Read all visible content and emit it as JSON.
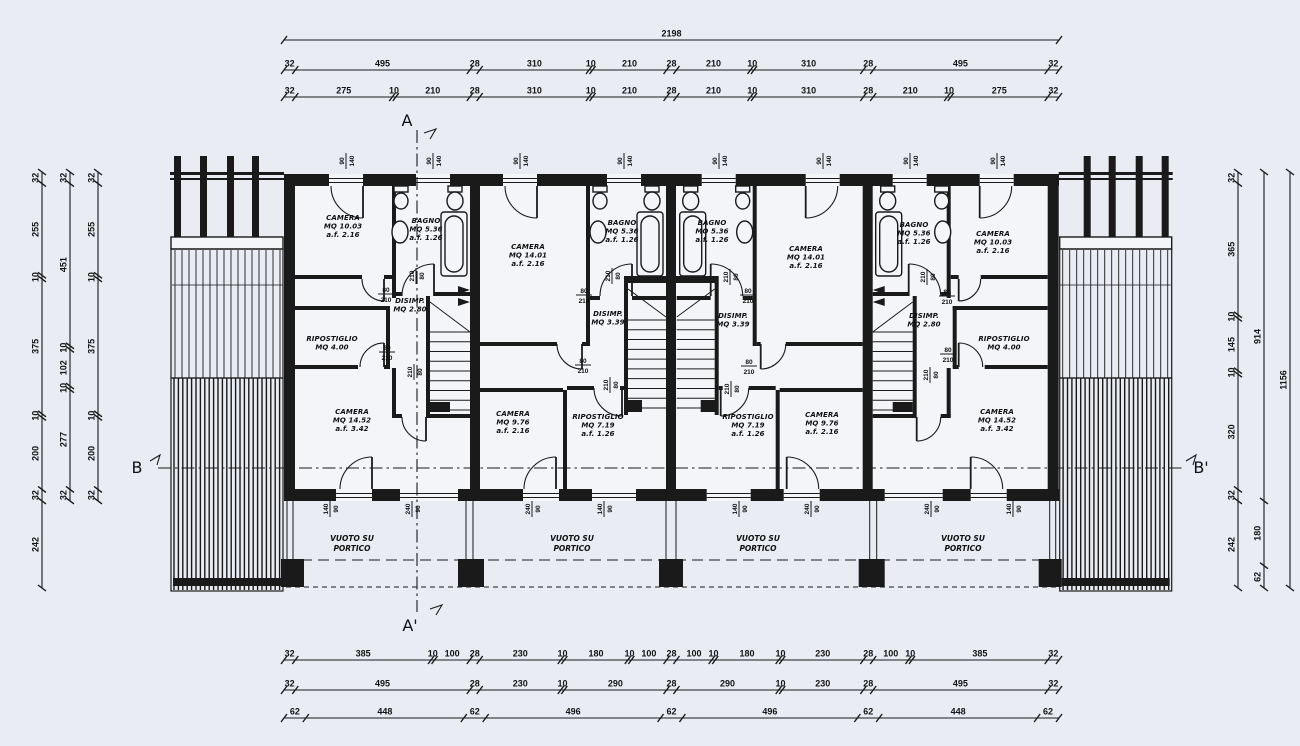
{
  "colors": {
    "paper": "#e9ecf3",
    "room_fill": "#f4f5f9",
    "ink": "#1a1a1a"
  },
  "sections": {
    "top": "A",
    "bottom": "A'",
    "left": "B",
    "right": "B'"
  },
  "dimensions": {
    "top": [
      [
        "2198"
      ],
      [
        "32",
        "495",
        "28",
        "310",
        "10",
        "210",
        "28",
        "210",
        "10",
        "310",
        "28",
        "495",
        "32"
      ],
      [
        "32",
        "275",
        "10",
        "210",
        "28",
        "310",
        "10",
        "210",
        "28",
        "210",
        "10",
        "310",
        "28",
        "210",
        "10",
        "275",
        "32"
      ]
    ],
    "bottom": [
      [
        "32",
        "385",
        "10",
        "100",
        "28",
        "230",
        "10",
        "180",
        "10",
        "100",
        "28",
        "100",
        "10",
        "180",
        "10",
        "230",
        "28",
        "100",
        "10",
        "385",
        "32"
      ],
      [
        "32",
        "495",
        "28",
        "230",
        "10",
        "290",
        "28",
        "290",
        "10",
        "230",
        "28",
        "495",
        "32"
      ],
      [
        "62",
        "448",
        "62",
        "496",
        "62",
        "496",
        "62",
        "448",
        "62"
      ]
    ],
    "left": [
      [
        "32",
        "255",
        "10",
        "375",
        "10",
        "200",
        "32",
        "242"
      ],
      [
        "32",
        "451",
        "10",
        "102",
        "10",
        "277",
        "32"
      ],
      [
        "32",
        "255",
        "10",
        "375",
        "10",
        "200",
        "32"
      ]
    ],
    "right": [
      [
        "32",
        "365",
        "10",
        "145",
        "10",
        "320",
        "32",
        "242"
      ],
      [
        "914",
        "180",
        "62"
      ],
      [
        "1156"
      ]
    ]
  },
  "rooms": [
    {
      "name": "CAMERA",
      "area": "MQ 10.03",
      "height": "a.f. 2.16"
    },
    {
      "name": "BAGNO",
      "area": "MQ 5.36",
      "height": "a.f. 1.26"
    },
    {
      "name": "DISIMP.",
      "area": "MQ 2.80",
      "height": ""
    },
    {
      "name": "RIPOSTIGLIO",
      "area": "MQ 4.00",
      "height": ""
    },
    {
      "name": "CAMERA",
      "area": "MQ 14.52",
      "height": "a.f. 3.42"
    },
    {
      "name": "CAMERA",
      "area": "MQ 14.01",
      "height": "a.f. 2.16"
    },
    {
      "name": "BAGNO",
      "area": "MQ 5.36",
      "height": "a.f. 1.26"
    },
    {
      "name": "DISIMP.",
      "area": "MQ 3.39",
      "height": ""
    },
    {
      "name": "CAMERA",
      "area": "MQ 9.76",
      "height": "a.f. 2.16"
    },
    {
      "name": "RIPOSTIGLIO",
      "area": "MQ 7.19",
      "height": "a.f. 1.26"
    },
    {
      "name": "BAGNO",
      "area": "MQ 5.36",
      "height": "a.f. 1.26"
    },
    {
      "name": "CAMERA",
      "area": "MQ 14.01",
      "height": "a.f. 2.16"
    },
    {
      "name": "DISIMP.",
      "area": "MQ 3.39",
      "height": ""
    },
    {
      "name": "RIPOSTIGLIO",
      "area": "MQ 7.19",
      "height": "a.f. 1.26"
    },
    {
      "name": "CAMERA",
      "area": "MQ 9.76",
      "height": "a.f. 2.16"
    },
    {
      "name": "BAGNO",
      "area": "MQ 5.36",
      "height": "a.f. 1.26"
    },
    {
      "name": "CAMERA",
      "area": "MQ 10.03",
      "height": "a.f. 2.16"
    },
    {
      "name": "DISIMP.",
      "area": "MQ 2.80",
      "height": ""
    },
    {
      "name": "RIPOSTIGLIO",
      "area": "MQ 4.00",
      "height": ""
    },
    {
      "name": "CAMERA",
      "area": "MQ 14.52",
      "height": "a.f. 3.42"
    }
  ],
  "porch_bays": [
    {
      "line1": "VUOTO SU",
      "line2": "PORTICO"
    },
    {
      "line1": "VUOTO SU",
      "line2": "PORTICO"
    },
    {
      "line1": "VUOTO SU",
      "line2": "PORTICO"
    },
    {
      "line1": "VUOTO SU",
      "line2": "PORTICO"
    }
  ],
  "size_labels": [
    {
      "num": "90",
      "den": "140"
    },
    {
      "num": "90",
      "den": "140"
    },
    {
      "num": "90",
      "den": "140"
    },
    {
      "num": "90",
      "den": "140"
    },
    {
      "num": "90",
      "den": "140"
    },
    {
      "num": "90",
      "den": "140"
    },
    {
      "num": "90",
      "den": "140"
    },
    {
      "num": "90",
      "den": "140"
    },
    {
      "num": "140",
      "den": "90"
    },
    {
      "num": "240",
      "den": "90"
    },
    {
      "num": "240",
      "den": "90"
    },
    {
      "num": "140",
      "den": "90"
    },
    {
      "num": "140",
      "den": "90"
    },
    {
      "num": "240",
      "den": "90"
    },
    {
      "num": "240",
      "den": "90"
    },
    {
      "num": "140",
      "den": "90"
    },
    {
      "num": "80",
      "den": "210"
    },
    {
      "num": "80",
      "den": "210"
    },
    {
      "num": "210",
      "den": "80"
    },
    {
      "num": "210",
      "den": "80"
    },
    {
      "num": "80",
      "den": "210"
    },
    {
      "num": "80",
      "den": "210"
    },
    {
      "num": "210",
      "den": "80"
    },
    {
      "num": "210",
      "den": "80"
    },
    {
      "num": "80",
      "den": "210"
    },
    {
      "num": "80",
      "den": "210"
    },
    {
      "num": "210",
      "den": "80"
    },
    {
      "num": "210",
      "den": "80"
    },
    {
      "num": "80",
      "den": "210"
    },
    {
      "num": "80",
      "den": "210"
    },
    {
      "num": "210",
      "den": "80"
    },
    {
      "num": "210",
      "den": "80"
    }
  ]
}
